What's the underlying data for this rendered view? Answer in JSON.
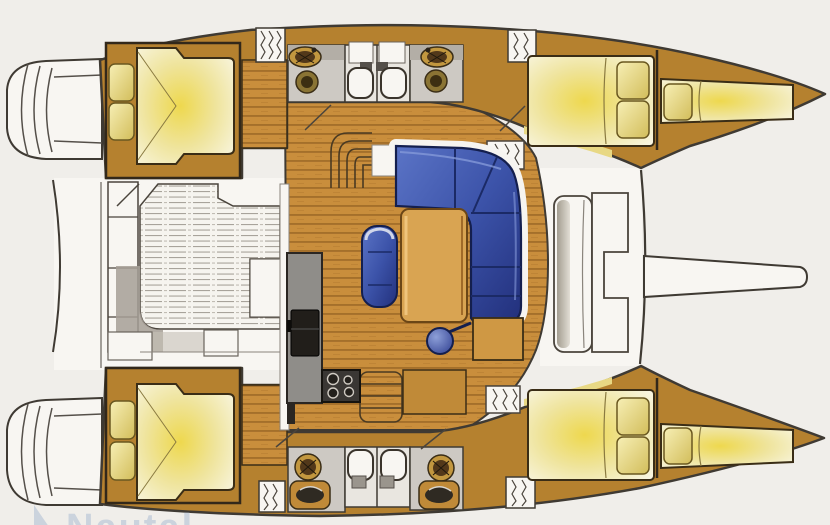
{
  "document": {
    "type": "Catamaran yacht interior floor plan, top view, bow to the right",
    "watermark": {
      "text": "Nautal"
    }
  },
  "colors": {
    "bg": "#f0eeea",
    "deck": "#f8f6f2",
    "hull": "#b5812f",
    "floor": "#c98e3c",
    "plank_line": "#8f5e20",
    "bath": "#cdc9c3",
    "bed_glow": "#eed84e",
    "pillow": "#f2e7a6",
    "sofa": "#3c53a9",
    "sofa_dark": "#1b2a66",
    "table": "#d9a452",
    "counter": "#8f8d89",
    "appliance": "#211e1a",
    "outline": "#3f3a33",
    "shadow": "#a69f96",
    "watermark": "#aebdd4"
  },
  "features": {
    "port_hull": [
      "aft-cabin-double-berth",
      "aft-head-sink-toilet",
      "shower-stall",
      "shower-stall",
      "forward-head-sink-toilet",
      "forward-cabin-double-berth",
      "forepeak-berth"
    ],
    "starboard_hull": [
      "aft-cabin-double-berth",
      "aft-head-sink-toilet",
      "shower-stall",
      "shower-stall",
      "forward-head-sink-toilet",
      "forward-cabin-double-berth",
      "forepeak-berth"
    ],
    "saloon": [
      "l-shaped-sofa",
      "chaise-bench",
      "dining-table",
      "swivel-stool",
      "galley-counter",
      "fridge",
      "stove-4-burners",
      "nav-counter",
      "hull-stairs",
      "companionway-hatch"
    ],
    "aft_deck": [
      "transom-steps",
      "cockpit-bench",
      "slatted-cockpit-floor",
      "sliding-door"
    ],
    "foredeck": [
      "forward-bench",
      "anchor-locker",
      "forward-beam",
      "bowsprit"
    ]
  }
}
